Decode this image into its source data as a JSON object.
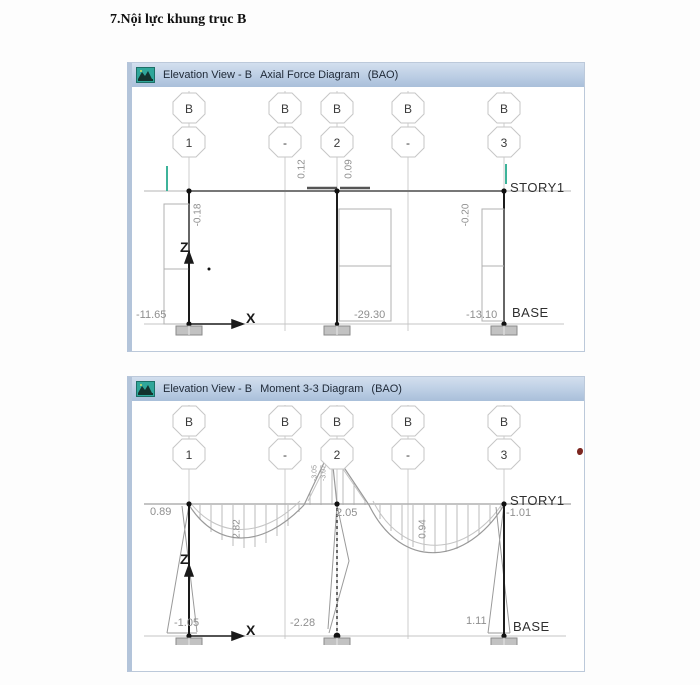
{
  "page": {
    "heading": "7.Nội lực khung trục B"
  },
  "win1": {
    "title_view": "Elevation View - B",
    "title_diagram": "Axial Force Diagram",
    "title_combo": "(BAO)",
    "grid_top": [
      "B",
      "B",
      "B",
      "B",
      "B"
    ],
    "grid_bottom": [
      "1",
      "-",
      "2",
      "-",
      "3"
    ],
    "story_label": "STORY1",
    "base_label": "BASE",
    "beam_axial": [
      "0.12",
      "0.09"
    ],
    "col_axial": [
      "-0.18",
      "-0.20"
    ],
    "base_axial": [
      "-11.65",
      "-29.30",
      "-13.10"
    ],
    "axis": {
      "z": "Z",
      "x": "X"
    }
  },
  "win2": {
    "title_view": "Elevation View - B",
    "title_diagram": "Moment 3-3 Diagram",
    "title_combo": "(BAO)",
    "grid_top": [
      "B",
      "B",
      "B",
      "B",
      "B"
    ],
    "grid_bottom": [
      "1",
      "-",
      "2",
      "-",
      "3"
    ],
    "story_label": "STORY1",
    "base_label": "BASE",
    "span_moments": [
      "2.82",
      "0.94"
    ],
    "story_moments": [
      "0.89",
      "2.05",
      "-1.01"
    ],
    "peak_moments": [
      "-3.05",
      "-3.07"
    ],
    "base_moments": [
      "-1.05",
      "-2.28",
      "1.11"
    ],
    "axis": {
      "z": "Z",
      "x": "X"
    }
  },
  "colors": {
    "accent_teal": "#3db39a",
    "titlebar_blue": "#bccee4",
    "line_gray": "#9a9a9a",
    "column_black": "#1c1c1c",
    "value_gray": "#8f8f8f"
  }
}
